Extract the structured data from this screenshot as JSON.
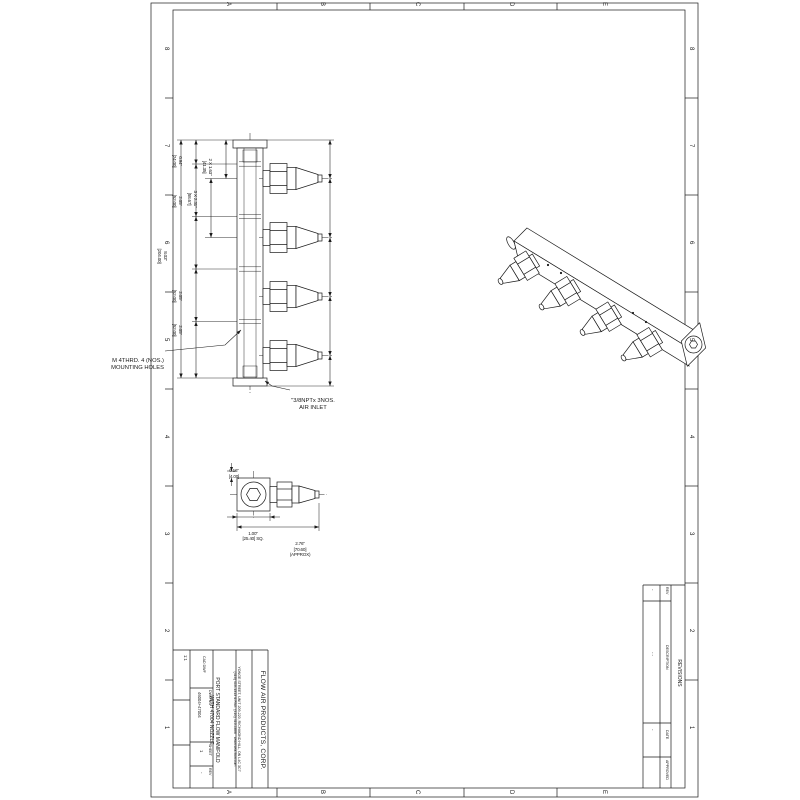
{
  "zones": {
    "cols": [
      "A",
      "B",
      "C",
      "D",
      "E"
    ],
    "rows": [
      "8",
      "7",
      "6",
      "5",
      "4",
      "3",
      "2",
      "1"
    ]
  },
  "front_view": {
    "dim_span_a": {
      "line1": "2 X 1.63\"",
      "line2": "[41.35]"
    },
    "dim_span_b": {
      "line1": "3 X 2.31\"",
      "line2": "[58.67]"
    },
    "dim_top": {
      "line1": "0.94\"",
      "line2": "[24.00]"
    },
    "dim_pitch1": {
      "line1": "2.05\"",
      "line2": "[52.00]"
    },
    "dim_pitch2": {
      "line1": "2.05\"",
      "line2": "[52.00]"
    },
    "dim_pitch3": {
      "line1": "2.05\"",
      "line2": "[52.00]"
    },
    "dim_overall": {
      "line1": "8.03\"",
      "line2": "[204.00]"
    },
    "note_mounting": {
      "line1": "M 4THRD. 4 (NOS.)",
      "line2": "MOUNTING HOLES"
    },
    "note_inlet": {
      "line1": "\"3/8NPTx 3NOS.",
      "line2": "AIR INLET"
    }
  },
  "detail_view": {
    "dim_offset": {
      "line1": "0.16\"",
      "line2": "[4.00]"
    },
    "dim_square": {
      "line1": "1.00\"",
      "line2": "[25.40] SQ."
    },
    "dim_length": {
      "line1": "2.76\"",
      "line2": "[70.60]",
      "line3": "(APPROX)"
    }
  },
  "title_block": {
    "company": "FLOW AIR PRODUCTS, CORP.",
    "address_line1": "YONGE STREET, UNIT 209-220, RICHMOND HILL, ON L4C 3C7",
    "address_line2": "(416) 410-1313 & FAX: (416) 410-1806   www.sea-flow.com",
    "title_line1": "PORT STANDARD FLOW MANIFOLD",
    "title_line2": "WITH 47004 NOZZLE",
    "scale": "1:1",
    "cad_label": "CAD DWF",
    "dwg_no_label": "DWG NO",
    "dwg_no": "46004+47004",
    "sheet_label": "SHEET",
    "sheet": "1",
    "rev_label": "REV",
    "rev": "-"
  },
  "revisions": {
    "banner": "REVISIONS",
    "col_rev": "REV",
    "col_description": "DESCRIPTION",
    "col_date": "DATE",
    "col_approved": "APPROVED",
    "val_rev": "-",
    "val_description": "- -",
    "val_date": "-",
    "val_approved": ""
  }
}
